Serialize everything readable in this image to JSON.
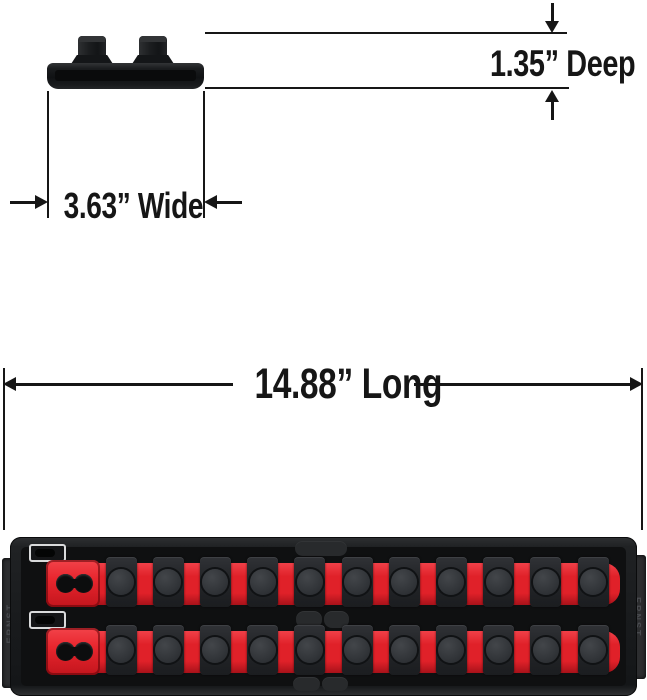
{
  "page": {
    "background": "#ffffff",
    "line_color": "#161616"
  },
  "dimensions": {
    "deep": "1.35” Deep",
    "wide": "3.63” Wide",
    "long": "14.88” Long"
  },
  "product": {
    "brand": "ERNST",
    "rows": [
      {
        "clip_count": 11
      },
      {
        "clip_count": 11
      }
    ],
    "colors": {
      "tray": "#1d1f21",
      "tray_inner": "#0f1011",
      "rail_red": "#e02129",
      "rail_red_light": "#f04048",
      "rail_red_dark": "#a8121a",
      "slider_red": "#e8262e",
      "clip": "#25272a",
      "peg": "#43464a",
      "tab": "#2c2d2f",
      "tab_text": "#4a4c50",
      "slot_outline": "#d9dadb"
    }
  }
}
